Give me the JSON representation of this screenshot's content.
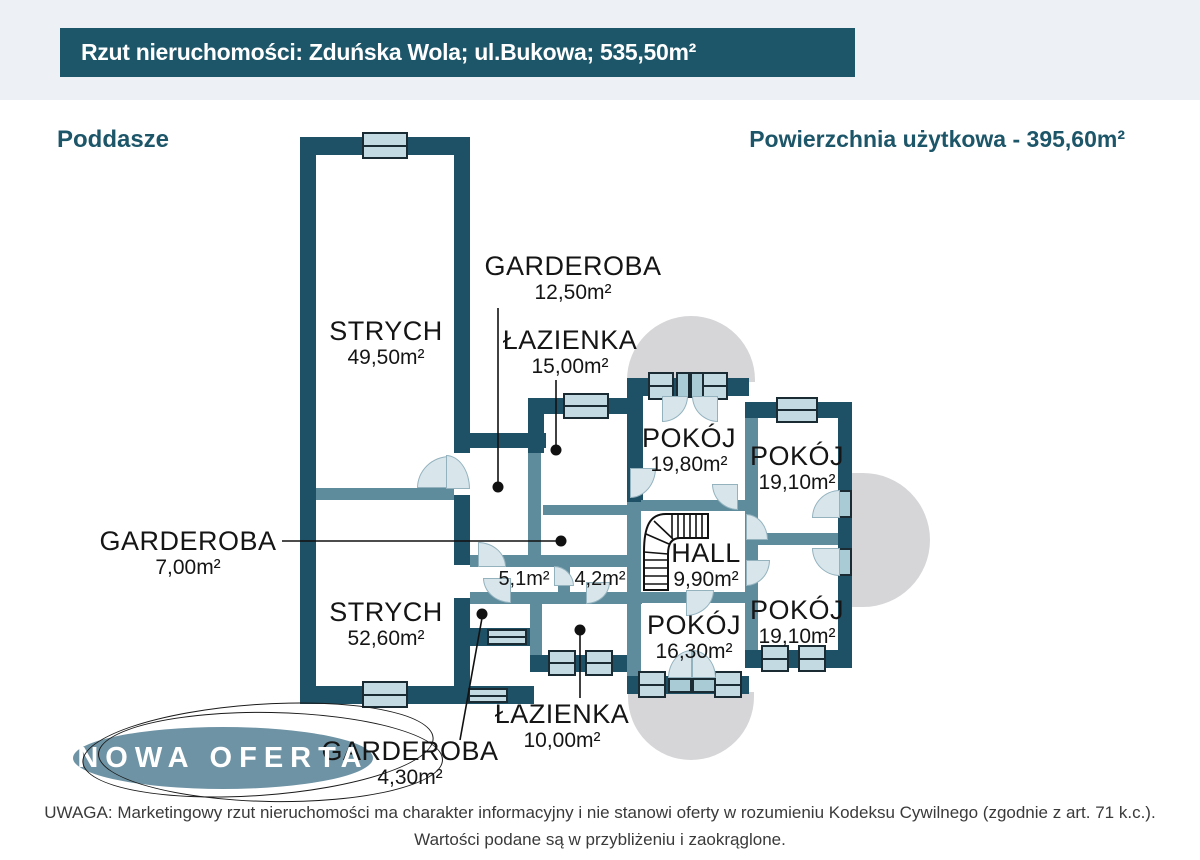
{
  "banner": {
    "text": "Rzut nieruchomości: Zduńska Wola; ul.Bukowa; 535,50m²",
    "bg": "#1d5669",
    "text_color": "#ffffff"
  },
  "plan_header": {
    "floor": "Poddasze",
    "usable_area": "Powierzchnia użytkowa - 395,60m²",
    "color": "#1d5669"
  },
  "colors": {
    "wall_dark": "#1e5165",
    "wall_light": "#5e8c9d",
    "window_fill": "#c3dae2",
    "door_fill": "#d8e6ec",
    "balcony": "#d6d6d8",
    "header_strip": "#edf1f5",
    "badge_fill": "#6e93a4"
  },
  "rooms": {
    "strych_top": {
      "name": "STRYCH",
      "area": "49,50m²"
    },
    "garderoba_top": {
      "name": "GARDEROBA",
      "area": "12,50m²"
    },
    "lazienka_top": {
      "name": "ŁAZIENKA",
      "area": "15,00m²"
    },
    "pokoj_top_center": {
      "name": "POKÓJ",
      "area": "19,80m²"
    },
    "pokoj_top_right": {
      "name": "POKÓJ",
      "area": "19,10m²"
    },
    "garderoba_left": {
      "name": "GARDEROBA",
      "area": "7,00m²"
    },
    "hall": {
      "name": "HALL",
      "area": "9,90m²"
    },
    "corridor_small_1": {
      "area": "5,1m²"
    },
    "corridor_small_2": {
      "area": "4,2m²"
    },
    "strych_bottom": {
      "name": "STRYCH",
      "area": "52,60m²"
    },
    "pokoj_bottom_center": {
      "name": "POKÓJ",
      "area": "16,30m²"
    },
    "pokoj_bottom_right": {
      "name": "POKÓJ",
      "area": "19,10m²"
    },
    "lazienka_bottom": {
      "name": "ŁAZIENKA",
      "area": "10,00m²"
    },
    "garderoba_bottom": {
      "name": "GARDEROBA",
      "area": "4,30m²"
    }
  },
  "badge": {
    "text": "NOWA OFERTA"
  },
  "footer": {
    "line1": "UWAGA: Marketingowy rzut nieruchomości ma charakter informacyjny i nie stanowi oferty w rozumieniu Kodeksu Cywilnego (zgodnie z art. 71 k.c.).",
    "line2": "Wartości podane są w przybliżeniu i zaokrąglone."
  }
}
